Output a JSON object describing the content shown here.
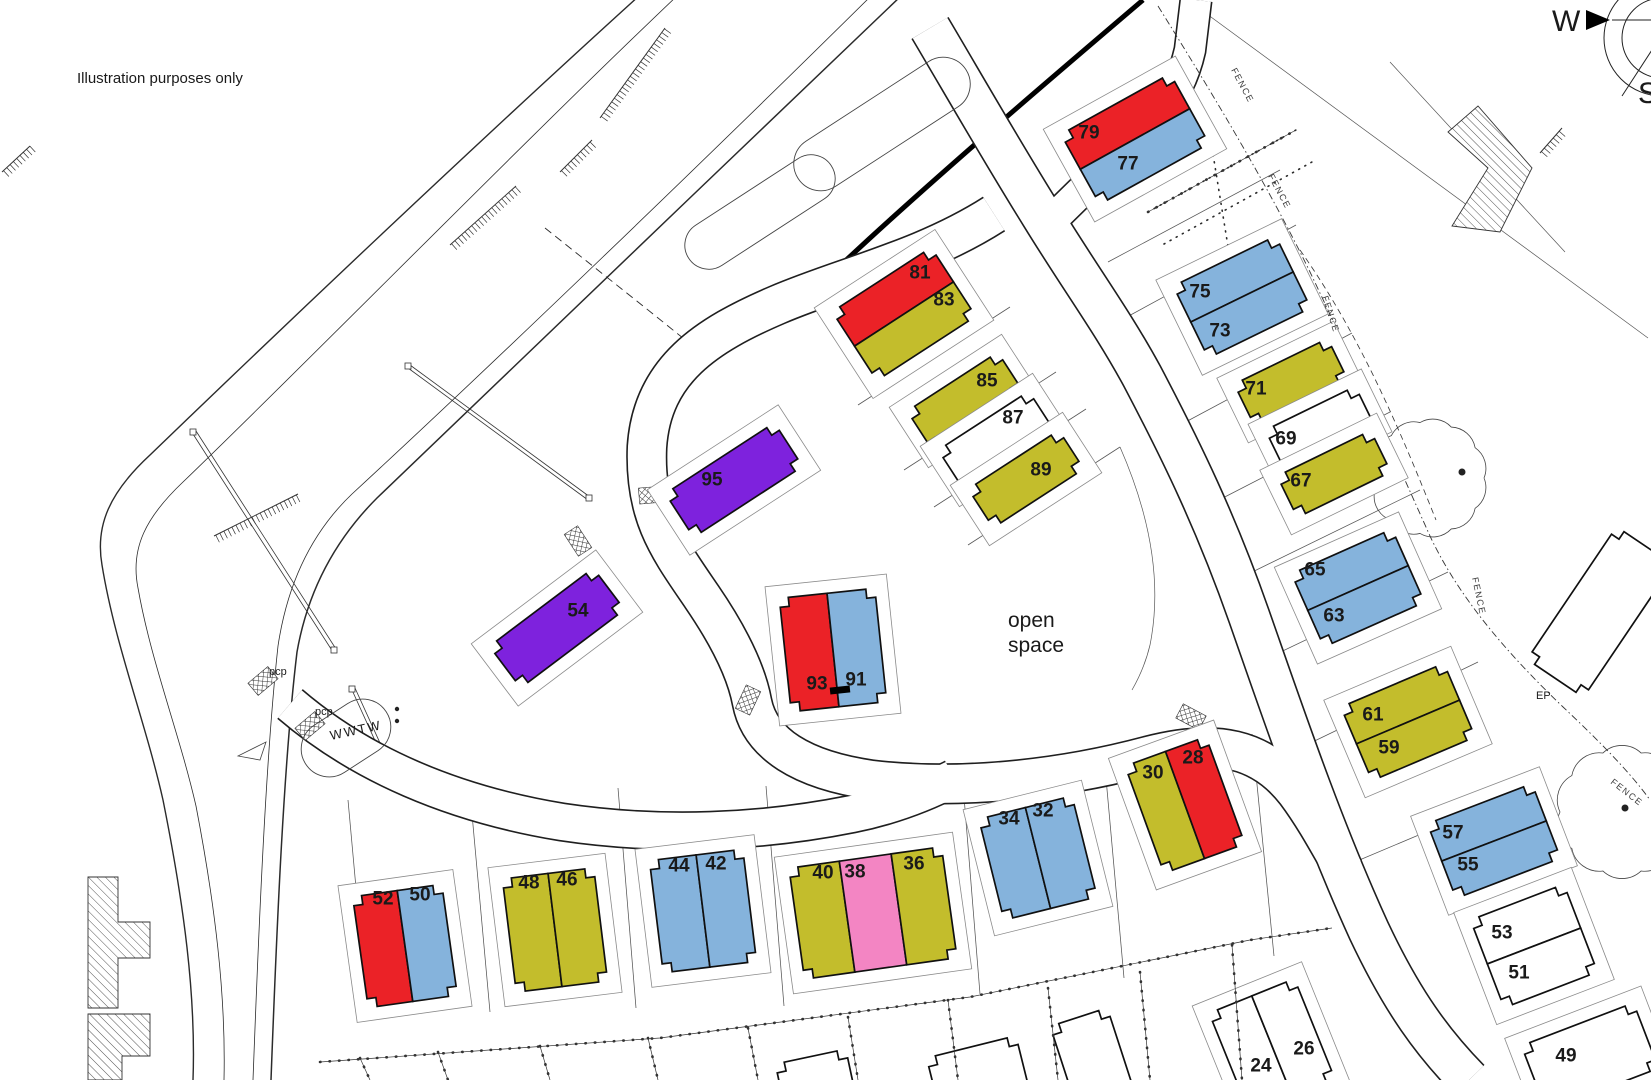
{
  "title_note": "Illustration purposes only",
  "annotations": {
    "open_space_line1": "open",
    "open_space_line2": "space",
    "wwtw": "WWTW",
    "pcp1": "pcp",
    "pcp2": "pcp",
    "ep": "EP"
  },
  "compass": {
    "west": "W",
    "south": "S"
  },
  "fence_label_text": "FENCE",
  "fence_labels": [
    {
      "x": 1231,
      "y": 70,
      "rot": 62
    },
    {
      "x": 1268,
      "y": 176,
      "rot": 62
    },
    {
      "x": 1322,
      "y": 297,
      "rot": 72
    },
    {
      "x": 1472,
      "y": 578,
      "rot": 78
    },
    {
      "x": 1610,
      "y": 783,
      "rot": 38
    }
  ],
  "palette": {
    "red": "#eb2227",
    "blue": "#85b3dc",
    "olive": "#c3bd2c",
    "purple": "#7e22dd",
    "pink": "#f385c3",
    "white": "#ffffff"
  },
  "plots": [
    {
      "cx": 1135,
      "cy": 139,
      "w": 125,
      "h": 80,
      "rot": -29,
      "split": "h",
      "units": [
        {
          "n": "79",
          "c": "red",
          "x": 1089,
          "y": 133
        },
        {
          "n": "77",
          "c": "blue",
          "x": 1128,
          "y": 164
        }
      ]
    },
    {
      "cx": 904,
      "cy": 314,
      "w": 118,
      "h": 82,
      "rot": -33,
      "split": "h",
      "units": [
        {
          "n": "81",
          "c": "red",
          "x": 920,
          "y": 273
        },
        {
          "n": "83",
          "c": "olive",
          "x": 944,
          "y": 300
        }
      ]
    },
    {
      "cx": 965,
      "cy": 401,
      "w": 108,
      "h": 46,
      "rot": -33,
      "split": null,
      "units": [
        {
          "n": "85",
          "c": "olive",
          "x": 987,
          "y": 381
        }
      ]
    },
    {
      "cx": 996,
      "cy": 440,
      "w": 108,
      "h": 46,
      "rot": -33,
      "split": null,
      "units": [
        {
          "n": "87",
          "c": "white",
          "x": 1013,
          "y": 418
        }
      ]
    },
    {
      "cx": 1026,
      "cy": 479,
      "w": 108,
      "h": 46,
      "rot": -33,
      "split": null,
      "units": [
        {
          "n": "89",
          "c": "olive",
          "x": 1041,
          "y": 470
        }
      ]
    },
    {
      "cx": 734,
      "cy": 480,
      "w": 130,
      "h": 52,
      "rot": -33,
      "split": null,
      "units": [
        {
          "n": "95",
          "c": "purple",
          "x": 712,
          "y": 480
        }
      ]
    },
    {
      "cx": 557,
      "cy": 628,
      "w": 130,
      "h": 52,
      "rot": -37,
      "split": null,
      "units": [
        {
          "n": "54",
          "c": "purple",
          "x": 578,
          "y": 611
        }
      ]
    },
    {
      "cx": 833,
      "cy": 650,
      "w": 96,
      "h": 114,
      "rot": -6,
      "split": "v",
      "units": [
        {
          "n": "93",
          "c": "red",
          "x": 817,
          "y": 684
        },
        {
          "n": "91",
          "c": "blue",
          "x": 856,
          "y": 680
        }
      ]
    },
    {
      "cx": 1242,
      "cy": 297,
      "w": 114,
      "h": 80,
      "rot": -26,
      "split": "h",
      "units": [
        {
          "n": "75",
          "c": "blue",
          "x": 1200,
          "y": 292
        },
        {
          "n": "73",
          "c": "blue",
          "x": 1220,
          "y": 331
        }
      ]
    },
    {
      "cx": 1291,
      "cy": 382,
      "w": 104,
      "h": 46,
      "rot": -26,
      "split": null,
      "units": [
        {
          "n": "71",
          "c": "olive",
          "x": 1256,
          "y": 389
        }
      ]
    },
    {
      "cx": 1320,
      "cy": 428,
      "w": 100,
      "h": 44,
      "rot": -26,
      "split": null,
      "units": [
        {
          "n": "69",
          "c": "white",
          "x": 1286,
          "y": 439
        }
      ]
    },
    {
      "cx": 1334,
      "cy": 474,
      "w": 104,
      "h": 46,
      "rot": -26,
      "split": null,
      "units": [
        {
          "n": "67",
          "c": "olive",
          "x": 1301,
          "y": 481
        }
      ]
    },
    {
      "cx": 1358,
      "cy": 588,
      "w": 110,
      "h": 80,
      "rot": -24,
      "split": "h",
      "units": [
        {
          "n": "65",
          "c": "blue",
          "x": 1315,
          "y": 570
        },
        {
          "n": "63",
          "c": "blue",
          "x": 1334,
          "y": 616
        }
      ]
    },
    {
      "cx": 1408,
      "cy": 722,
      "w": 112,
      "h": 80,
      "rot": -23,
      "split": "h",
      "units": [
        {
          "n": "61",
          "c": "olive",
          "x": 1373,
          "y": 715
        },
        {
          "n": "59",
          "c": "olive",
          "x": 1389,
          "y": 748
        }
      ]
    },
    {
      "cx": 1494,
      "cy": 841,
      "w": 112,
      "h": 80,
      "rot": -21,
      "split": "h",
      "units": [
        {
          "n": "57",
          "c": "blue",
          "x": 1453,
          "y": 833
        },
        {
          "n": "55",
          "c": "blue",
          "x": 1468,
          "y": 865
        }
      ]
    },
    {
      "cx": 1534,
      "cy": 946,
      "w": 100,
      "h": 94,
      "rot": -21,
      "split": "h",
      "units": [
        {
          "n": "53",
          "c": "white",
          "x": 1502,
          "y": 933
        },
        {
          "n": "51",
          "c": "white",
          "x": 1519,
          "y": 973
        }
      ]
    },
    {
      "cx": 1590,
      "cy": 1057,
      "w": 120,
      "h": 70,
      "rot": -21,
      "split": null,
      "units": [
        {
          "n": "49",
          "c": "white",
          "x": 1566,
          "y": 1056
        }
      ]
    },
    {
      "cx": 405,
      "cy": 946,
      "w": 90,
      "h": 112,
      "rot": -8,
      "split": "v",
      "units": [
        {
          "n": "52",
          "c": "red",
          "x": 383,
          "y": 899
        },
        {
          "n": "50",
          "c": "blue",
          "x": 420,
          "y": 895
        }
      ]
    },
    {
      "cx": 555,
      "cy": 930,
      "w": 92,
      "h": 114,
      "rot": -7,
      "split": "v",
      "units": [
        {
          "n": "48",
          "c": "olive",
          "x": 529,
          "y": 883
        },
        {
          "n": "46",
          "c": "olive",
          "x": 567,
          "y": 880
        }
      ]
    },
    {
      "cx": 703,
      "cy": 911,
      "w": 94,
      "h": 113,
      "rot": -7,
      "split": "v",
      "units": [
        {
          "n": "44",
          "c": "blue",
          "x": 679,
          "y": 866
        },
        {
          "n": "42",
          "c": "blue",
          "x": 716,
          "y": 864
        }
      ]
    },
    {
      "cx": 873,
      "cy": 913,
      "w": 154,
      "h": 112,
      "rot": -8,
      "split": "v3",
      "units": [
        {
          "n": "40",
          "c": "olive",
          "x": 823,
          "y": 873
        },
        {
          "n": "38",
          "c": "pink",
          "x": 855,
          "y": 872
        },
        {
          "n": "36",
          "c": "olive",
          "x": 914,
          "y": 864
        }
      ]
    },
    {
      "cx": 1038,
      "cy": 858,
      "w": 96,
      "h": 104,
      "rot": -14,
      "split": "v",
      "units": [
        {
          "n": "34",
          "c": "blue",
          "x": 1009,
          "y": 819
        },
        {
          "n": "32",
          "c": "blue",
          "x": 1043,
          "y": 811
        }
      ]
    },
    {
      "cx": 1185,
      "cy": 805,
      "w": 86,
      "h": 114,
      "rot": -20,
      "split": "v",
      "units": [
        {
          "n": "30",
          "c": "olive",
          "x": 1153,
          "y": 773
        },
        {
          "n": "28",
          "c": "red",
          "x": 1193,
          "y": 758
        }
      ]
    },
    {
      "cx": 1272,
      "cy": 1046,
      "w": 92,
      "h": 108,
      "rot": -22,
      "split": "v",
      "units": [
        {
          "n": "24",
          "c": "white",
          "x": 1261,
          "y": 1066
        },
        {
          "n": "26",
          "c": "white",
          "x": 1304,
          "y": 1049
        }
      ]
    },
    {
      "cx": 816,
      "cy": 1082,
      "w": 72,
      "h": 52,
      "rot": -12,
      "split": null,
      "nocurt": true,
      "units": [
        {
          "n": "",
          "c": "white",
          "x": 0,
          "y": 0
        }
      ]
    },
    {
      "cx": 978,
      "cy": 1074,
      "w": 92,
      "h": 56,
      "rot": -14,
      "split": null,
      "nocurt": true,
      "units": [
        {
          "n": "",
          "c": "white",
          "x": 0,
          "y": 0
        }
      ]
    },
    {
      "cx": 1092,
      "cy": 1058,
      "w": 60,
      "h": 86,
      "rot": -18,
      "split": null,
      "nocurt": true,
      "units": [
        {
          "n": "",
          "c": "white",
          "x": 0,
          "y": 0
        }
      ]
    },
    {
      "cx": 1600,
      "cy": 612,
      "w": 160,
      "h": 68,
      "rot": -56,
      "split": null,
      "nocurt": true,
      "units": [
        {
          "n": "",
          "c": "white",
          "x": 0,
          "y": 0
        }
      ]
    }
  ]
}
